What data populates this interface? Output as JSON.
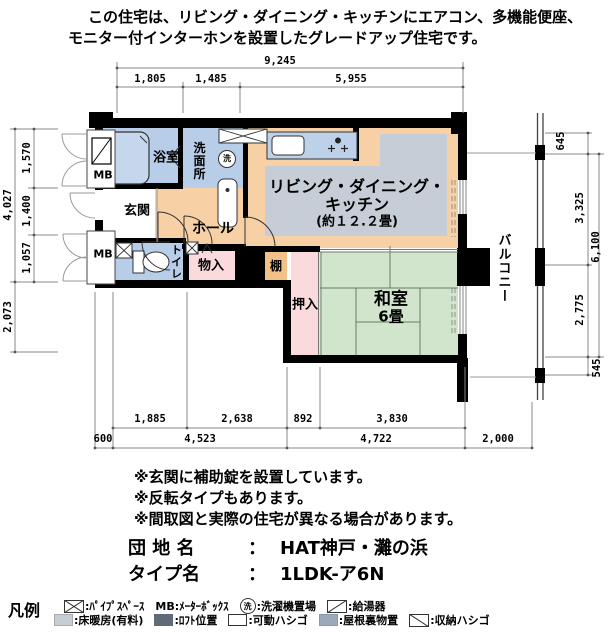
{
  "header": {
    "line1": "この住宅は、リビング・ダイニング・キッチンにエアコン、多機能便座、",
    "line2": "モニター付インターホンを設置したグレードアップ住宅です。"
  },
  "rooms": {
    "bath": "浴室",
    "washroom": "洗面所",
    "wash_symbol": "洗",
    "entrance": "玄関",
    "hall": "ホール",
    "toilet": "トイレ",
    "storage": "物入",
    "shelf": "棚",
    "closet": "押入",
    "washitsu_name": "和室",
    "washitsu_size": "6畳",
    "ldk_line1": "リビング・ダイニング・",
    "ldk_line2": "キッチン",
    "ldk_line3": "(約１２.２畳)",
    "balcony": "バルコニー",
    "mb_top": "MB",
    "mb_bottom": "MB"
  },
  "dims": {
    "top_total": "9,245",
    "top_segments": [
      "1,805",
      "1,485",
      "5,955"
    ],
    "left_outer": [
      "4,027",
      "2,073"
    ],
    "left_inner": [
      "1,570",
      "1,400",
      "1,057"
    ],
    "right_segments": [
      "645",
      "3,325",
      "2,775",
      "545"
    ],
    "right_total": "6,100",
    "bottom_upper": [
      "1,885",
      "2,638",
      "892",
      "3,830"
    ],
    "bottom_lower": [
      "600",
      "4,523",
      "4,722",
      "2,000"
    ]
  },
  "notes": [
    "※玄関に補助錠を設置しています。",
    "※反転タイプもあります。",
    "※間取図と実際の住宅が異なる場合があります。"
  ],
  "property": {
    "estate_label": "団 地 名",
    "estate_sep": "：",
    "estate_value": "HAT神戸・灘の浜",
    "type_label": "タイプ名",
    "type_sep": "：",
    "type_value": "1LDK-ア6N"
  },
  "legend": {
    "title": "凡例",
    "row1": [
      {
        "icon": "pipe-space",
        "label": ":ﾊﾟｲﾌﾟｽﾍﾟｰｽ"
      },
      {
        "icon": "none",
        "label": "MB:ﾒｰﾀｰﾎﾞｯｸｽ"
      },
      {
        "icon": "wash-circle",
        "icon_text": "洗",
        "label": ":洗濯機置場"
      },
      {
        "icon": "water-heater",
        "label": ":給湯器"
      }
    ],
    "row2": [
      {
        "icon": "floor-heating",
        "label": ":床暖房(有料)"
      },
      {
        "icon": "loft",
        "label": ":ﾛﾌﾄ位置"
      },
      {
        "icon": "movable-ladder",
        "label": ":可動ハシゴ"
      },
      {
        "icon": "attic-storage",
        "label": ":屋根裏物置"
      },
      {
        "icon": "storage-ladder",
        "label": ":収納ハシゴ"
      }
    ]
  },
  "colors": {
    "room_blue": "#b7cde8",
    "counter_blue": "#bdd2e9",
    "ldk_orange": "#f8d0a6",
    "shelf_orange": "#f2c187",
    "closet_pink": "#fadadd",
    "tatami_green": "#d0e5cb",
    "floor_heating_gray": "#c6cdd6",
    "wall_black": "#000000",
    "legend_floorheat": "#c5cdd5",
    "legend_loft": "#5f6b77",
    "legend_attic": "#9aaab8"
  }
}
